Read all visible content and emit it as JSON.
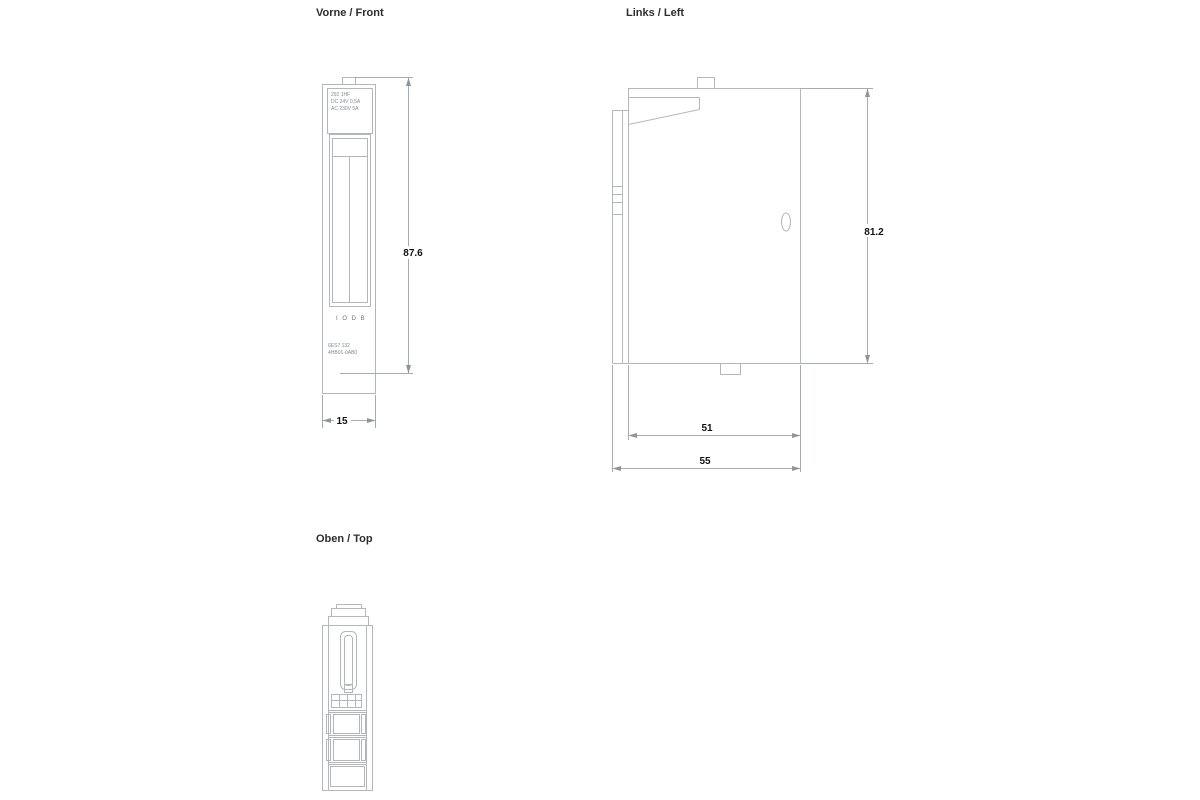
{
  "drawing": {
    "views": {
      "front": {
        "title": "Vorne / Front"
      },
      "left": {
        "title": "Links / Left"
      },
      "top": {
        "title": "Oben / Top"
      }
    },
    "dimensions_mm": {
      "front_height": "87.6",
      "front_width": "15",
      "left_height": "81.2",
      "left_depth_inner": "51",
      "left_depth_outer": "55"
    },
    "front_module": {
      "label_lines": [
        "292 1HF",
        "DC 24V 0,5A",
        "AC 230V 5A"
      ],
      "marking_row": "I O D B",
      "part_number_lines": [
        "6ES7 132",
        "4HB01-0AB0"
      ]
    },
    "colors": {
      "background": "#ffffff",
      "line": "#b4b7ba",
      "dimension_text": "#121212",
      "tiny_text": "#83888c"
    }
  }
}
